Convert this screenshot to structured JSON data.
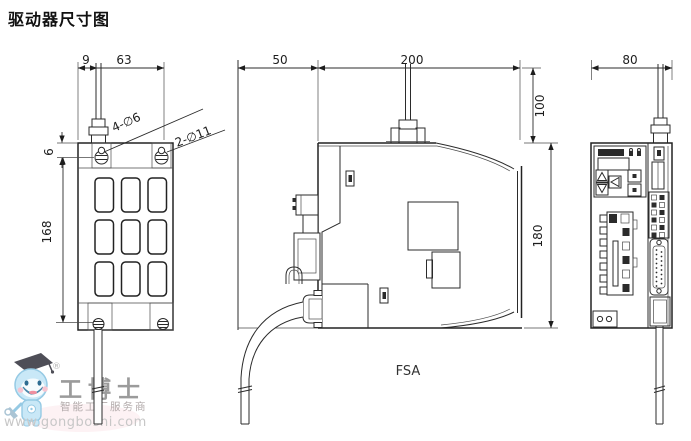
{
  "title": "驱动器尺寸图",
  "views": {
    "left": {
      "dim_cable_offset": "9",
      "dim_width": "63",
      "dim_hole_edge": "6",
      "dim_hole_pitch": "168",
      "label_small_holes": "4-∅6",
      "label_large_holes": "2-∅11"
    },
    "middle": {
      "dim_front_clearance": "50",
      "dim_depth": "200",
      "dim_top_clearance": "100",
      "dim_height": "180",
      "frame_size_label": "FSA"
    },
    "right": {
      "dim_width": "80"
    }
  },
  "watermark": {
    "brand": "工博士",
    "registered_mark": "®",
    "tagline": "智能工厂服务商",
    "website": "www.gongboshi.com"
  }
}
